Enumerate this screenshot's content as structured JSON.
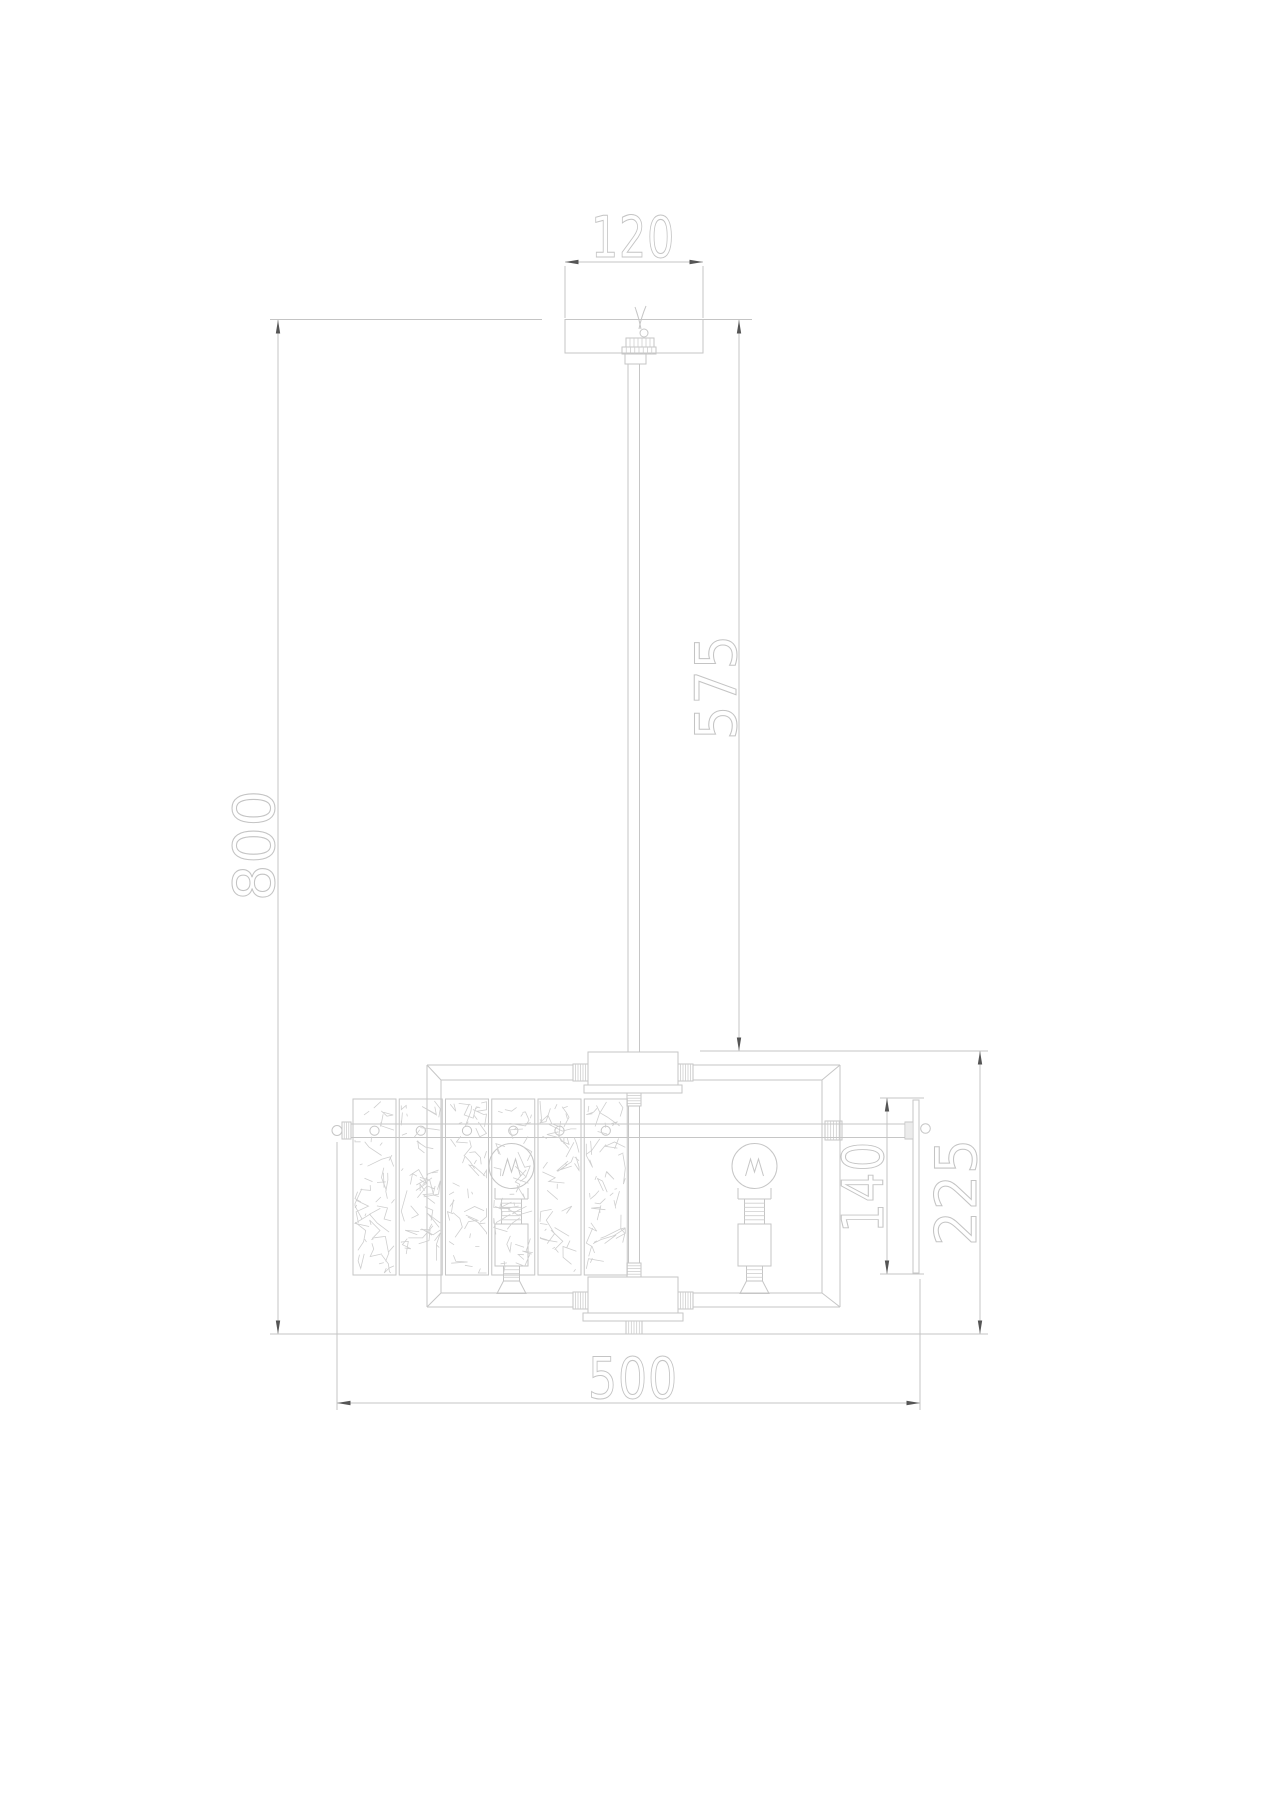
{
  "figure": {
    "type": "technical-dimension-drawing",
    "subject": "pendant-chandelier-front-elevation"
  },
  "palette": {
    "background": "#ffffff",
    "line": "#c6c6c6",
    "texture_line": "#cfcfcf",
    "arrow": "#555555",
    "dimension_text": "#c4c4c4"
  },
  "dimensions": {
    "canopy_width": {
      "label": "120"
    },
    "drop_rod_length": {
      "label": "575"
    },
    "overall_height": {
      "label": "800"
    },
    "crystal_panel_height": {
      "label": "140"
    },
    "body_height": {
      "label": "225"
    },
    "body_width": {
      "label": "500"
    }
  }
}
